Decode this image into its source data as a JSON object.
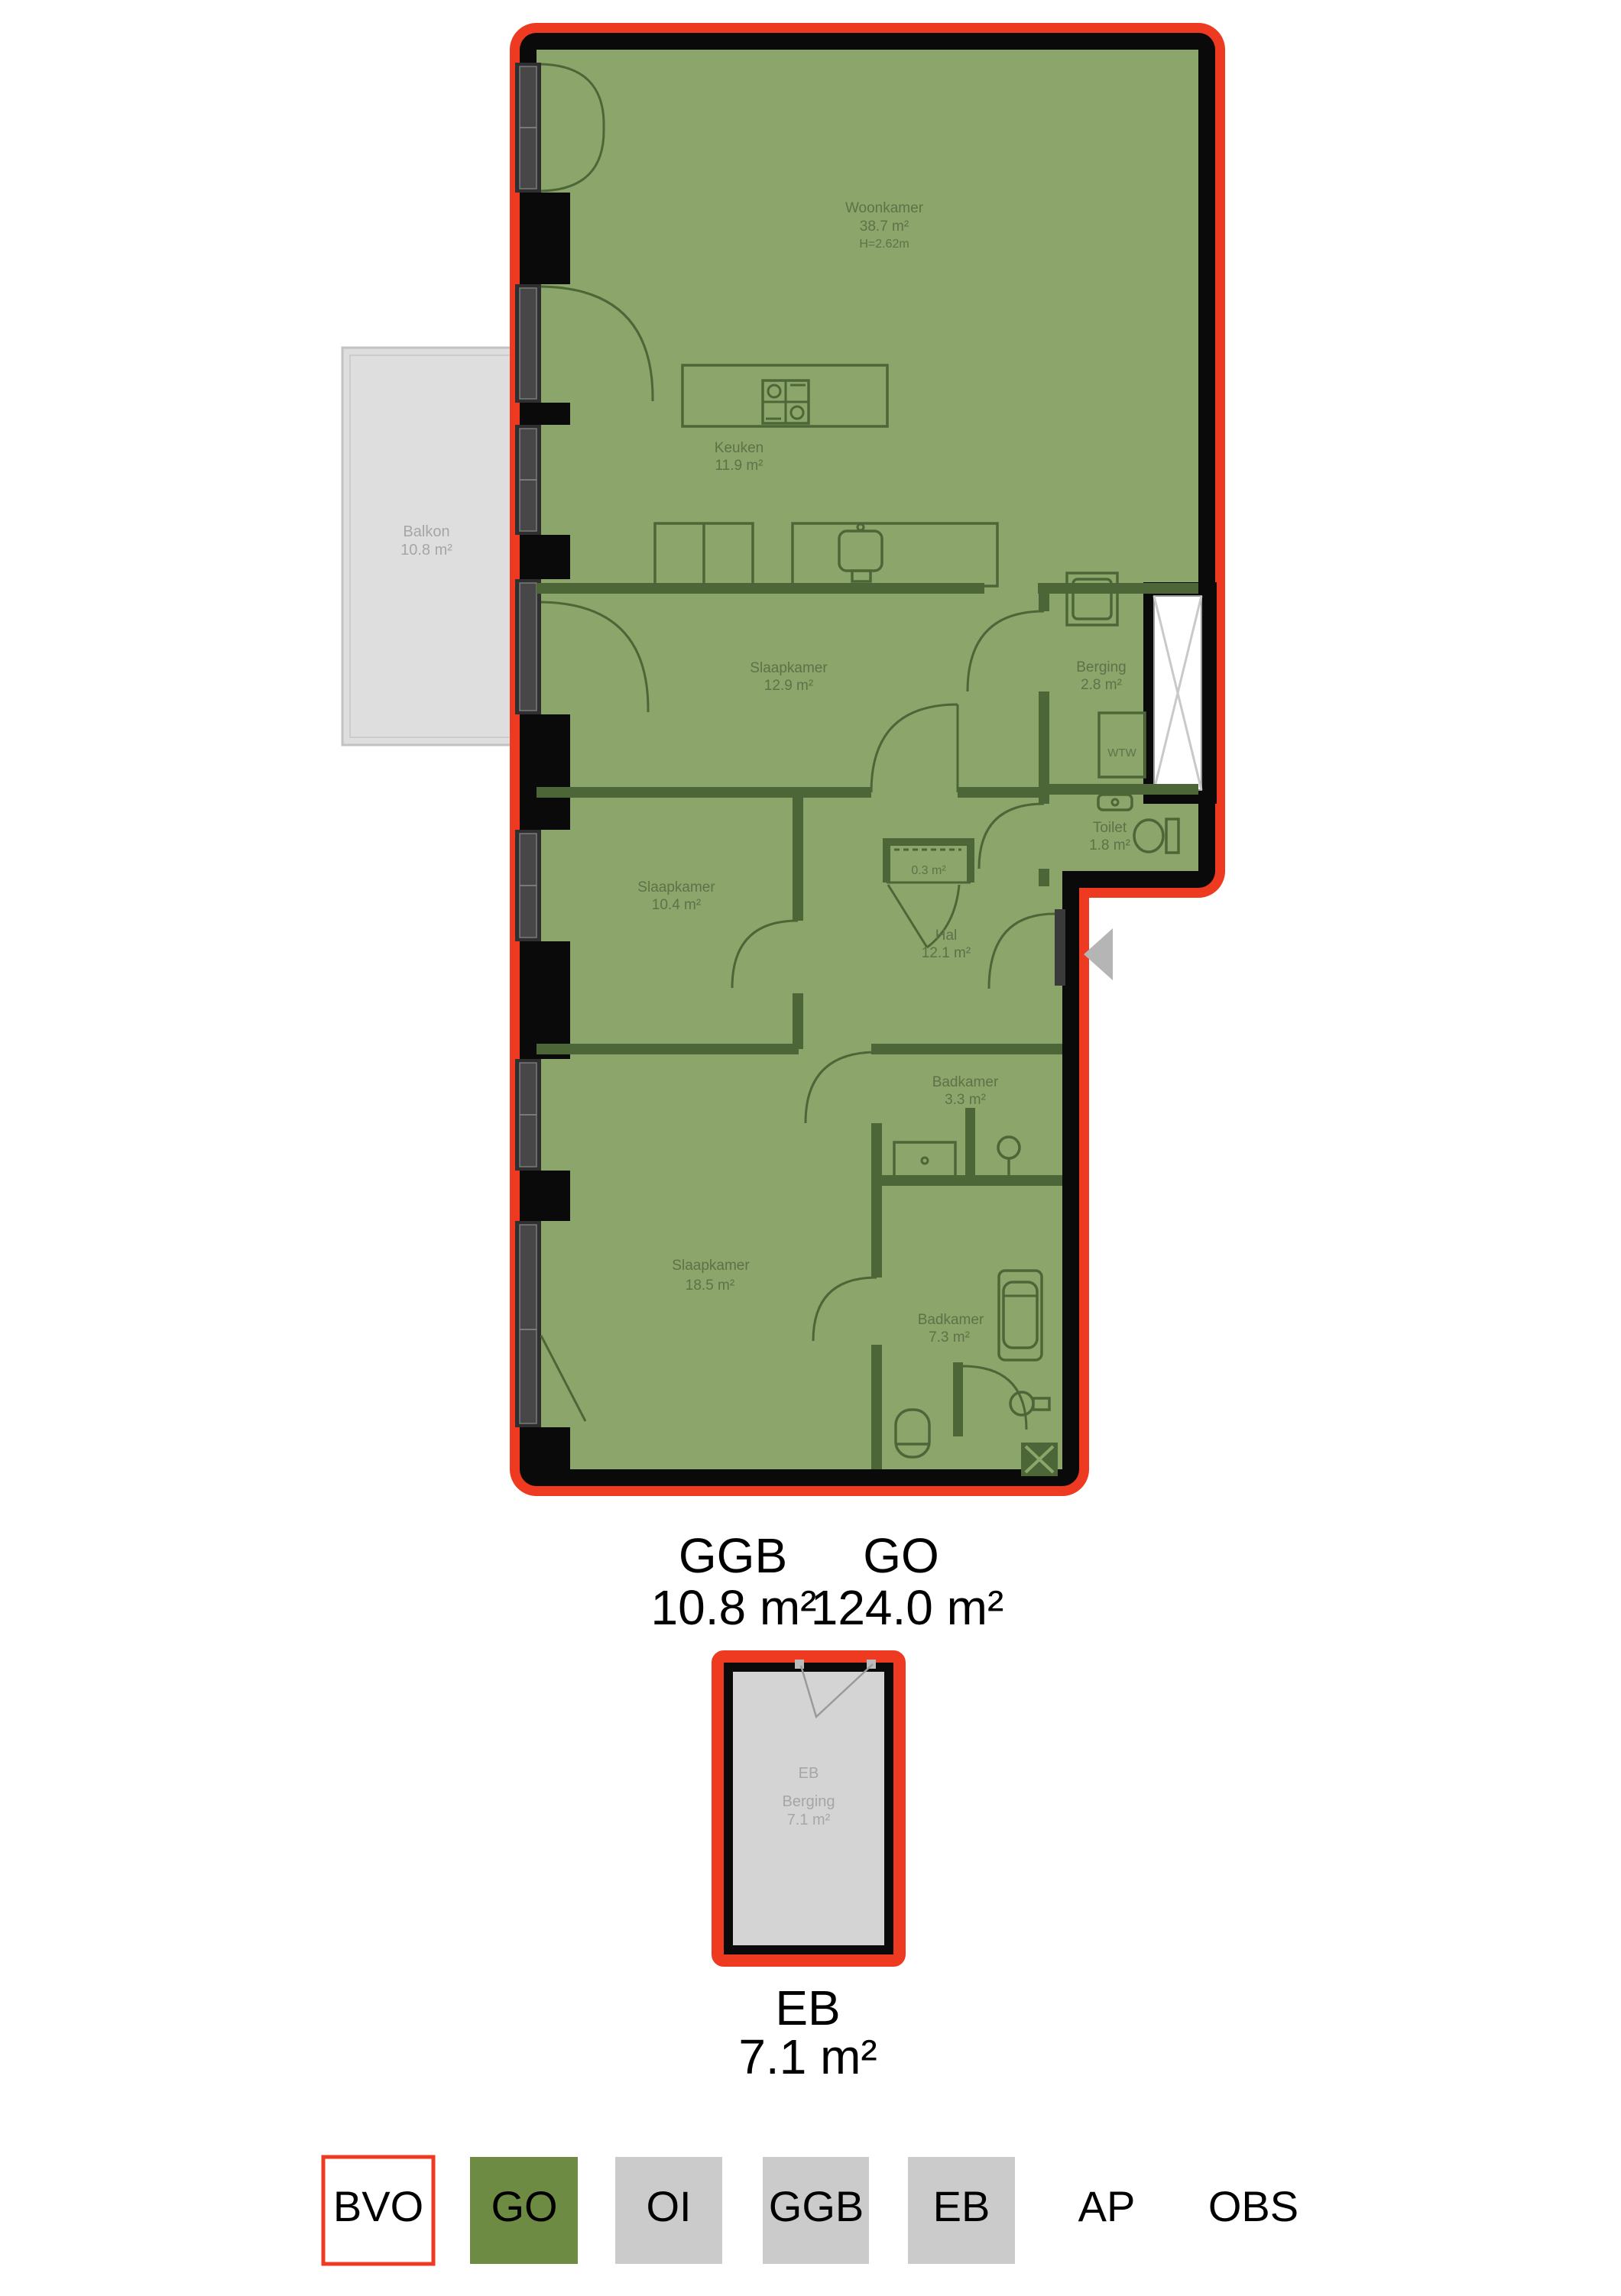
{
  "colors": {
    "bvo_red": "#ee3a20",
    "go_green": "#6d8b43",
    "plan_fill": "#8ca56b",
    "wall_black": "#0a0a0a",
    "interior_wall": "#4d6638",
    "room_text": "#5f7149",
    "grey_fill": "#cbcbcb",
    "grey_text": "#a6a6a6"
  },
  "floorplan": {
    "rooms": {
      "woonkamer": {
        "name": "Woonkamer",
        "area": "38.7 m²",
        "ceiling_height": "H=2.62m"
      },
      "keuken": {
        "name": "Keuken",
        "area": "11.9 m²"
      },
      "slaapkamer_1": {
        "name": "Slaapkamer",
        "area": "12.9 m²"
      },
      "berging": {
        "name": "Berging",
        "area": "2.8 m²"
      },
      "wtw": {
        "label": "WTW"
      },
      "toilet": {
        "name": "Toilet",
        "area": "1.8 m²"
      },
      "meterkast": {
        "area": "0.3 m²"
      },
      "hal": {
        "name": "Hal",
        "area": "12.1 m²"
      },
      "slaapkamer_2": {
        "name": "Slaapkamer",
        "area": "10.4 m²"
      },
      "badkamer_1": {
        "name": "Badkamer",
        "area": "3.3 m²"
      },
      "slaapkamer_3": {
        "name": "Slaapkamer",
        "area": "18.5 m²"
      },
      "badkamer_2": {
        "name": "Badkamer",
        "area": "7.3 m²"
      },
      "balkon": {
        "name": "Balkon",
        "area": "10.8 m²"
      }
    }
  },
  "summary": {
    "items": [
      {
        "label": "GGB",
        "value": "10.8 m²"
      },
      {
        "label": "GO",
        "value": "124.0 m²"
      }
    ]
  },
  "external_berging": {
    "code": "EB",
    "name": "Berging",
    "area": "7.1 m²"
  },
  "external_caption": {
    "label": "EB",
    "value": "7.1 m²"
  },
  "legend": {
    "items": [
      {
        "label": "BVO",
        "swatch": "outline-red"
      },
      {
        "label": "GO",
        "swatch": "green"
      },
      {
        "label": "OI",
        "swatch": "grey"
      },
      {
        "label": "GGB",
        "swatch": "grey"
      },
      {
        "label": "EB",
        "swatch": "grey"
      },
      {
        "label": "AP",
        "swatch": "none"
      },
      {
        "label": "OBS",
        "swatch": "none"
      }
    ]
  }
}
